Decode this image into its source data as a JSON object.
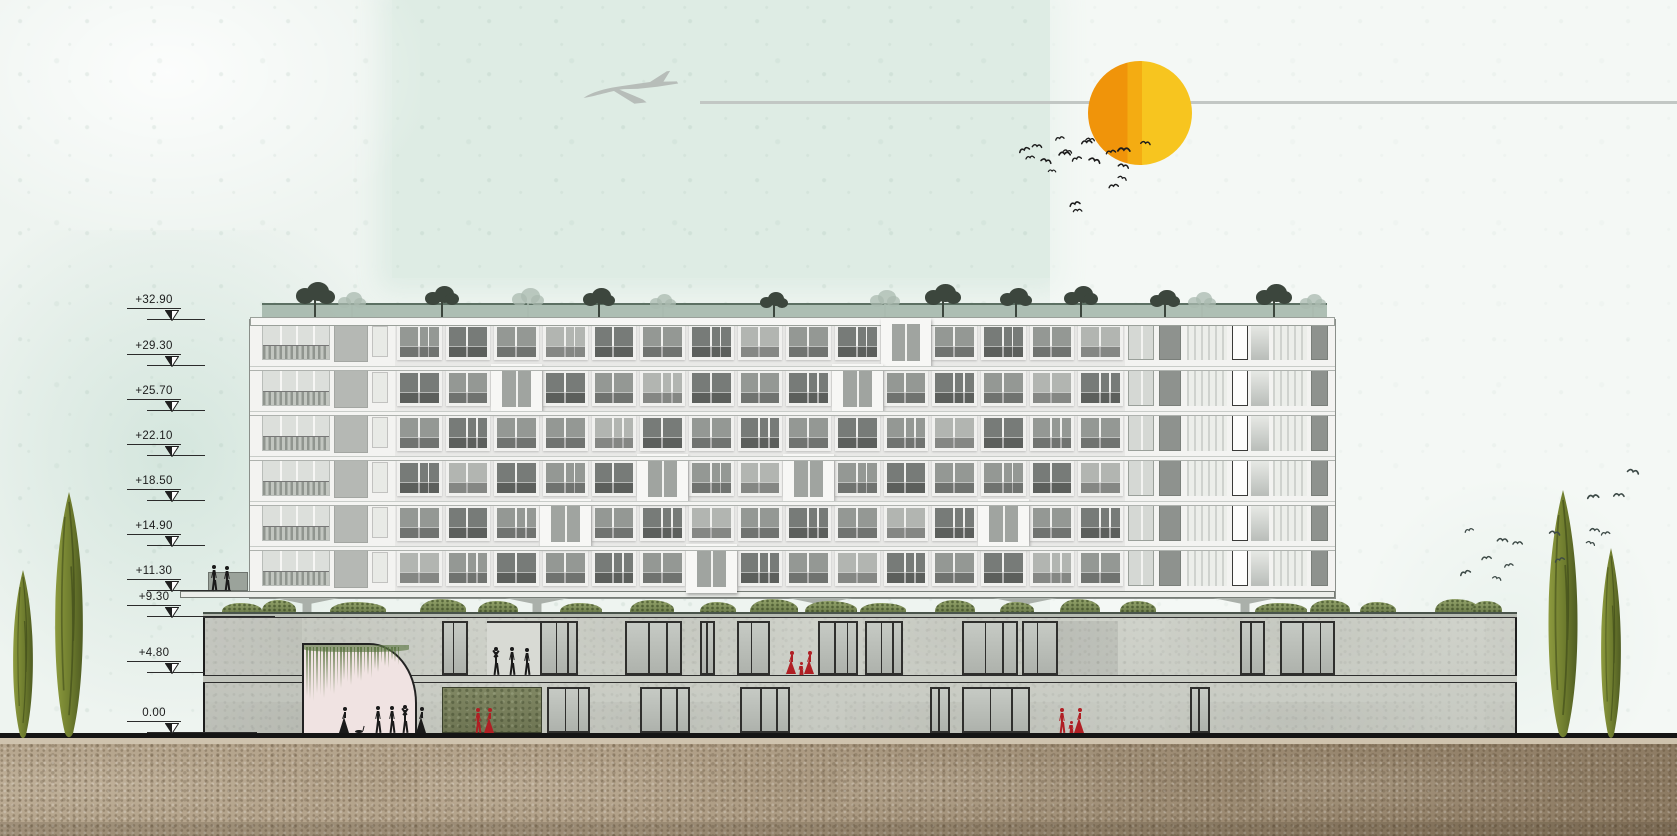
{
  "document": {
    "type": "architectural elevation-section drawing",
    "subject": "slab apartment block on two-storey podium with roof garden, sun, airplane, birds and cypress trees",
    "units": "meters"
  },
  "levels": [
    {
      "label": "+32.90",
      "y": 320,
      "line_w": 58
    },
    {
      "label": "+29.30",
      "y": 366,
      "line_w": 58
    },
    {
      "label": "+25.70",
      "y": 411,
      "line_w": 58
    },
    {
      "label": "+22.10",
      "y": 456,
      "line_w": 58
    },
    {
      "label": "+18.50",
      "y": 501,
      "line_w": 58
    },
    {
      "label": "+14.90",
      "y": 546,
      "line_w": 58
    },
    {
      "label": "+11.30",
      "y": 591,
      "line_w": 84
    },
    {
      "label": "+9.30",
      "y": 617,
      "line_w": 128
    },
    {
      "label": "+4.80",
      "y": 673,
      "line_w": 58
    },
    {
      "label": "0.00",
      "y": 733,
      "line_w": 110
    }
  ],
  "colors": {
    "sky_base": "#eef4f0",
    "sky_mint": "#dcebe3",
    "contrail": "#c2c7c4",
    "plane": "#b7bdb9",
    "sun_left": "#f0940a",
    "sun_mid": "#f4ac12",
    "sun_right": "#f7c51f",
    "bird_dark": "#1c1c1c",
    "bird_gray": "#3d4a47",
    "facade_white": "#f3f3f1",
    "window_dark": "#777b78",
    "window_mid": "#949894",
    "window_light": "#b2b5b1",
    "frame_white": "#f1f1ef",
    "frame_dark": "#2f2f2d",
    "glass": "#bfc3bd",
    "hedge": "rgba(156,176,164,0.8)",
    "hedge_edge": "#5c7063",
    "tree_dark": "#3c463d",
    "tree_ghost": "rgba(170,185,175,0.75)",
    "arch_pink": "#f0e3e2",
    "vine": "#587340",
    "people_black": "#1a1a1a",
    "people_red": "#b01f24",
    "ground": "#151515"
  },
  "sun": {
    "cx": 1140,
    "cy": 113,
    "r": 52,
    "split": 0.38
  },
  "airplane": {
    "x": 580,
    "y": 70,
    "w": 100,
    "h": 46,
    "contrail_y": 102,
    "contrail_from": 700
  },
  "birds_near_sun": [
    [
      1016,
      140,
      12
    ],
    [
      1024,
      147,
      10
    ],
    [
      1032,
      136,
      11
    ],
    [
      1042,
      151,
      12
    ],
    [
      1053,
      128,
      10
    ],
    [
      1058,
      144,
      13
    ],
    [
      1064,
      141,
      10
    ],
    [
      1069,
      149,
      11
    ],
    [
      1080,
      132,
      12
    ],
    [
      1086,
      129,
      10
    ],
    [
      1090,
      151,
      13
    ],
    [
      1104,
      142,
      11
    ],
    [
      1117,
      140,
      14
    ],
    [
      1119,
      156,
      12
    ],
    [
      1067,
      194,
      12
    ],
    [
      1072,
      200,
      10
    ],
    [
      1141,
      133,
      11
    ],
    [
      1120,
      168,
      10
    ],
    [
      1107,
      176,
      11
    ],
    [
      1048,
      160,
      9
    ]
  ],
  "birds_right": [
    [
      1457,
      563,
      12
    ],
    [
      1480,
      548,
      11
    ],
    [
      1497,
      530,
      12
    ],
    [
      1494,
      568,
      10
    ],
    [
      1502,
      555,
      10
    ],
    [
      1512,
      533,
      11
    ],
    [
      1550,
      523,
      12
    ],
    [
      1552,
      550,
      11
    ],
    [
      1586,
      487,
      13
    ],
    [
      1590,
      520,
      11
    ],
    [
      1588,
      533,
      10
    ],
    [
      1599,
      523,
      10
    ],
    [
      1613,
      485,
      12
    ],
    [
      1628,
      462,
      13
    ],
    [
      1462,
      520,
      10
    ]
  ],
  "tower": {
    "x": 250,
    "w": 1085,
    "top": 320,
    "bottom": 598,
    "roof_slab_top": 317,
    "hedge_top": 303,
    "floor_tops": [
      320,
      366,
      411,
      456,
      501,
      546
    ],
    "floor_h": 45,
    "center": {
      "x": 395,
      "w": 730,
      "cols": 15,
      "grid": [
        [
          1,
          0,
          1,
          2,
          0,
          1,
          0,
          2,
          1,
          0,
          3,
          1,
          0,
          1,
          2
        ],
        [
          0,
          1,
          3,
          0,
          1,
          2,
          0,
          1,
          0,
          3,
          1,
          0,
          1,
          2,
          0
        ],
        [
          1,
          0,
          1,
          1,
          2,
          0,
          1,
          0,
          1,
          0,
          1,
          2,
          0,
          1,
          1
        ],
        [
          0,
          2,
          0,
          1,
          0,
          3,
          1,
          2,
          3,
          1,
          0,
          1,
          1,
          0,
          2
        ],
        [
          1,
          0,
          1,
          3,
          1,
          0,
          2,
          1,
          0,
          1,
          2,
          0,
          3,
          1,
          0
        ],
        [
          2,
          1,
          0,
          1,
          0,
          1,
          3,
          0,
          1,
          2,
          0,
          1,
          0,
          2,
          1
        ]
      ]
    },
    "left_wing": {
      "x": 250,
      "w": 145
    },
    "right_wing": {
      "x": 1125,
      "w": 210
    }
  },
  "roof_trees": {
    "dark": [
      [
        296,
        36
      ],
      [
        425,
        32
      ],
      [
        583,
        30
      ],
      [
        760,
        26
      ],
      [
        925,
        34
      ],
      [
        1000,
        30
      ],
      [
        1064,
        32
      ],
      [
        1150,
        28
      ],
      [
        1256,
        34
      ]
    ],
    "ghost": [
      [
        338,
        26
      ],
      [
        512,
        30
      ],
      [
        650,
        24
      ],
      [
        870,
        28
      ],
      [
        1188,
        26
      ],
      [
        1300,
        24
      ]
    ]
  },
  "pilotis": {
    "slab": {
      "x": 180,
      "w": 1155,
      "y": 591,
      "h": 7
    },
    "block": {
      "x": 208,
      "w": 40,
      "y": 572,
      "h": 19
    },
    "columns": [
      307,
      537,
      820,
      1025,
      1245
    ],
    "col_w": 64,
    "y": 598,
    "h": 20
  },
  "podium": {
    "x": 203,
    "w": 1314,
    "roof_y": 612,
    "roof_h": 6,
    "top": 618,
    "mid_y": 675,
    "mid_h": 8,
    "bottom": 733,
    "arch": {
      "x": 302,
      "w": 115,
      "top": 643,
      "radius": 48
    },
    "green_wall": {
      "x": 442,
      "w": 100
    },
    "recess": {
      "x": 487,
      "w": 53
    },
    "upper_glass": [
      [
        442,
        26
      ],
      [
        540,
        38
      ],
      [
        625,
        57
      ],
      [
        700,
        15
      ],
      [
        737,
        33
      ],
      [
        818,
        40
      ],
      [
        865,
        38
      ],
      [
        962,
        56
      ],
      [
        1022,
        36
      ],
      [
        1240,
        25
      ],
      [
        1280,
        55
      ]
    ],
    "lower_glass": [
      [
        547,
        43
      ],
      [
        640,
        50
      ],
      [
        740,
        50
      ],
      [
        930,
        20
      ],
      [
        962,
        68
      ],
      [
        1190,
        20
      ]
    ],
    "dark_patch": {
      "x": 1058,
      "w": 60
    }
  },
  "shrubs": [
    [
      222,
      40
    ],
    [
      262,
      34
    ],
    [
      330,
      56
    ],
    [
      420,
      46
    ],
    [
      478,
      40
    ],
    [
      560,
      42
    ],
    [
      630,
      44
    ],
    [
      700,
      36
    ],
    [
      750,
      48
    ],
    [
      805,
      52
    ],
    [
      860,
      46
    ],
    [
      935,
      40
    ],
    [
      1000,
      34
    ],
    [
      1060,
      40
    ],
    [
      1120,
      36
    ],
    [
      1255,
      52
    ],
    [
      1310,
      40
    ],
    [
      1360,
      36
    ],
    [
      1435,
      44
    ],
    [
      1472,
      30
    ]
  ],
  "cypresses": [
    [
      8,
      570,
      30
    ],
    [
      48,
      492,
      42
    ],
    [
      1541,
      490,
      44
    ],
    [
      1596,
      548,
      30
    ]
  ],
  "people_groups": [
    {
      "color": "black",
      "foot_y": 591,
      "figures": [
        [
          214,
          26,
          "stand"
        ],
        [
          227,
          25,
          "stand"
        ]
      ]
    },
    {
      "color": "black",
      "foot_y": 675,
      "figures": [
        [
          496,
          28,
          "up"
        ],
        [
          512,
          28,
          "stand"
        ],
        [
          527,
          27,
          "stand"
        ]
      ]
    },
    {
      "color": "red",
      "foot_y": 675,
      "figures": [
        [
          792,
          24,
          "dress"
        ],
        [
          801,
          13,
          "child"
        ],
        [
          810,
          24,
          "dress"
        ]
      ]
    },
    {
      "color": "black",
      "foot_y": 733,
      "figures": [
        [
          345,
          26,
          "dress"
        ],
        [
          360,
          5,
          "cat"
        ],
        [
          378,
          27,
          "stand"
        ],
        [
          392,
          27,
          "stand"
        ],
        [
          405,
          28,
          "up"
        ],
        [
          422,
          26,
          "dress"
        ]
      ]
    },
    {
      "color": "red",
      "foot_y": 733,
      "figures": [
        [
          478,
          25,
          "stand"
        ],
        [
          490,
          25,
          "dress"
        ]
      ]
    },
    {
      "color": "red",
      "foot_y": 733,
      "figures": [
        [
          1062,
          25,
          "stand"
        ],
        [
          1071,
          12,
          "child"
        ],
        [
          1080,
          25,
          "dress"
        ]
      ]
    }
  ]
}
